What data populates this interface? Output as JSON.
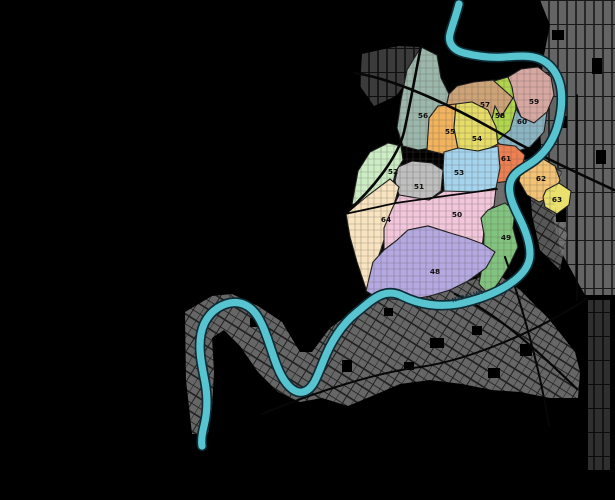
{
  "map": {
    "river": {
      "name": "NIDELVA",
      "water_color": "#57c4cf",
      "casing_color": "#0f2c36"
    },
    "colors": {
      "background": "#000000",
      "road": "#070707",
      "city_block_gray": "#767676",
      "block_street_line": "#222222",
      "ward_border": "#1c1c1c",
      "unnumbered_area": "#6f6f6f"
    },
    "wards": {
      "w48": {
        "number": "48",
        "color": "#b5a9e2"
      },
      "w49": {
        "number": "49",
        "color": "#82c47f"
      },
      "w50": {
        "number": "50",
        "color": "#f2c6db"
      },
      "w51": {
        "number": "51",
        "color": "#bfbfbf"
      },
      "w52": {
        "number": "52",
        "color": "#cdeec5"
      },
      "w53": {
        "number": "53",
        "color": "#a5d5ee"
      },
      "w54": {
        "number": "54",
        "color": "#e6dc68"
      },
      "w55": {
        "number": "55",
        "color": "#f2b35d"
      },
      "w56": {
        "number": "56",
        "color": "#9cb7ab"
      },
      "w57": {
        "number": "57",
        "color": "#cda377"
      },
      "w58": {
        "number": "58",
        "color": "#b1d64c"
      },
      "w59": {
        "number": "59",
        "color": "#d7a8a2"
      },
      "w60": {
        "number": "60",
        "color": "#8ab5c2"
      },
      "w61": {
        "number": "61",
        "color": "#ee8051"
      },
      "w62": {
        "number": "62",
        "color": "#f3c375"
      },
      "w63": {
        "number": "63",
        "color": "#e9e06e"
      },
      "w64": {
        "number": "64",
        "color": "#f8e4c0"
      }
    }
  }
}
